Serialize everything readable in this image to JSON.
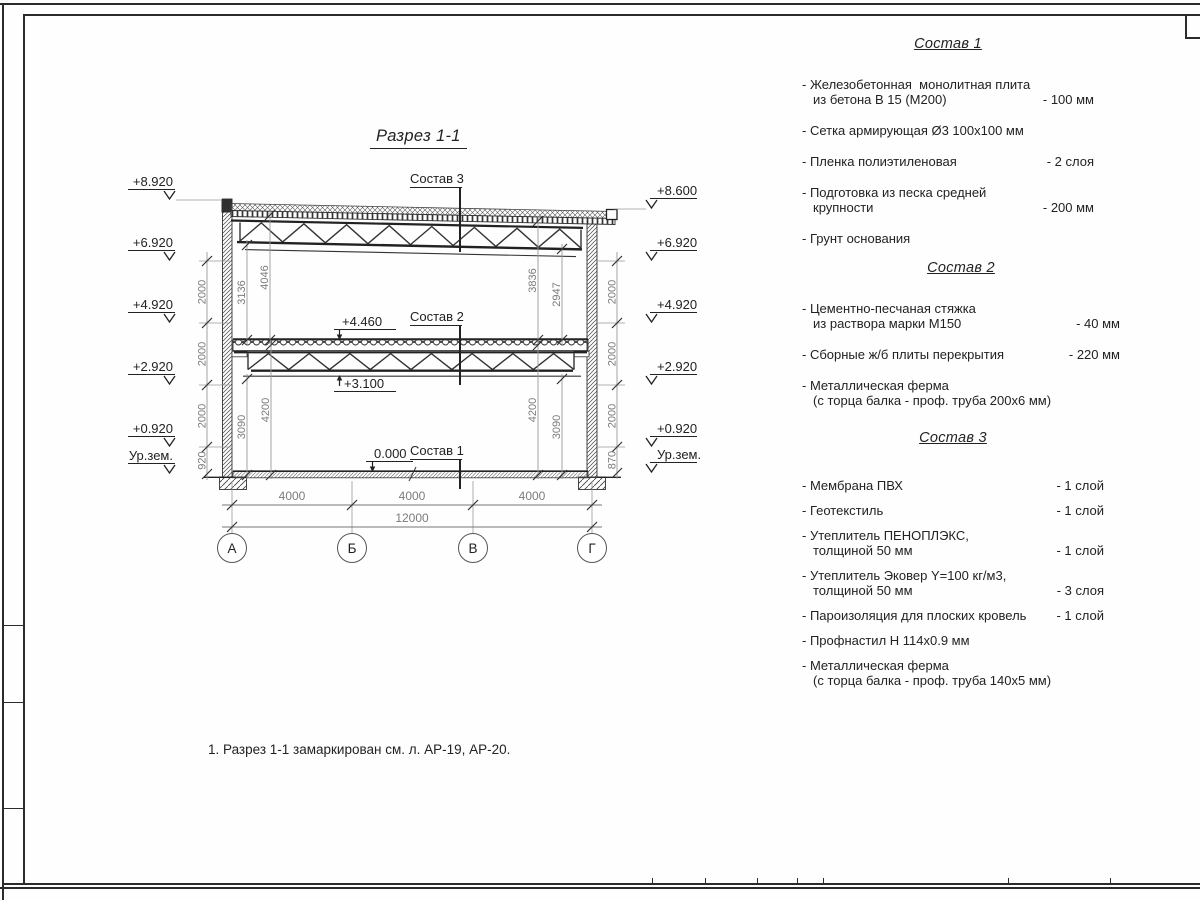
{
  "sheet": {
    "title": "Разрез 1-1",
    "note": "1. Разрез 1-1 замаркирован см. л. АР-19, АР-20."
  },
  "drawing": {
    "composition_labels": {
      "c3": "Состав 3",
      "c2": "Состав 2",
      "c1": "Состав 1"
    },
    "elevations_left": [
      "+8.920",
      "+6.920",
      "+4.920",
      "+2.920",
      "+0.920",
      "Ур.зем."
    ],
    "elevations_right": [
      "+8.600",
      "+6.920",
      "+4.920",
      "+2.920",
      "+0.920",
      "Ур.зем."
    ],
    "level_marks": {
      "floor2_top": "+4.460",
      "truss2_bottom": "+3.100",
      "floor1": "0.000"
    },
    "dims": {
      "left_chain": [
        "2000",
        "2000",
        "2000",
        "920"
      ],
      "right_chain": [
        "2000",
        "2000",
        "2000",
        "870"
      ],
      "inner_upper_left": [
        "3136",
        "4046"
      ],
      "inner_upper_right": [
        "3836",
        "2947"
      ],
      "inner_lower_left": [
        "3090",
        "4200"
      ],
      "inner_lower_right": [
        "4200",
        "3090"
      ],
      "spans": [
        "4000",
        "4000",
        "4000"
      ],
      "total": "12000"
    },
    "axes": [
      "А",
      "Б",
      "В",
      "Г"
    ]
  },
  "specs": [
    {
      "title": "Состав 1",
      "items": [
        {
          "text": "- Железобетонная  монолитная плита\nиз бетона В 15 (М200)",
          "value": "- 100 мм"
        },
        {
          "text": "- Сетка армирующая Ø3 100х100 мм",
          "value": ""
        },
        {
          "text": "- Пленка полиэтиленовая",
          "value": "-  2 слоя"
        },
        {
          "text": "- Подготовка из песка средней\nкрупности",
          "value": "- 200 мм"
        },
        {
          "text": "- Грунт основания",
          "value": ""
        }
      ]
    },
    {
      "title": "Состав 2",
      "items": [
        {
          "text": "- Цементно-песчаная стяжка\nиз раствора марки М150",
          "value": "- 40 мм"
        },
        {
          "text": "- Сборные ж/б плиты перекрытия",
          "value": "- 220 мм"
        },
        {
          "text": "- Металлическая ферма\n(с торца балка - проф. труба 200х6 мм)",
          "value": ""
        }
      ]
    },
    {
      "title": "Состав 3",
      "items": [
        {
          "text": "- Мембрана ПВХ",
          "value": "- 1 слой"
        },
        {
          "text": "- Геотекстиль",
          "value": "- 1 слой"
        },
        {
          "text": "- Утеплитель ПЕНОПЛЭКС,\nтолщиной 50 мм",
          "value": "- 1 слой"
        },
        {
          "text": "- Утеплитель Эковер Y=100 кг/м3,\nтолщиной 50 мм",
          "value": "- 3 слоя"
        },
        {
          "text": "- Пароизоляция для плоских кровель",
          "value": "- 1 слой"
        },
        {
          "text": "- Профнастил Н 114х0.9 мм",
          "value": ""
        },
        {
          "text": "- Металлическая ферма\n(с торца балка - проф. труба 140х5 мм)",
          "value": ""
        }
      ]
    }
  ]
}
